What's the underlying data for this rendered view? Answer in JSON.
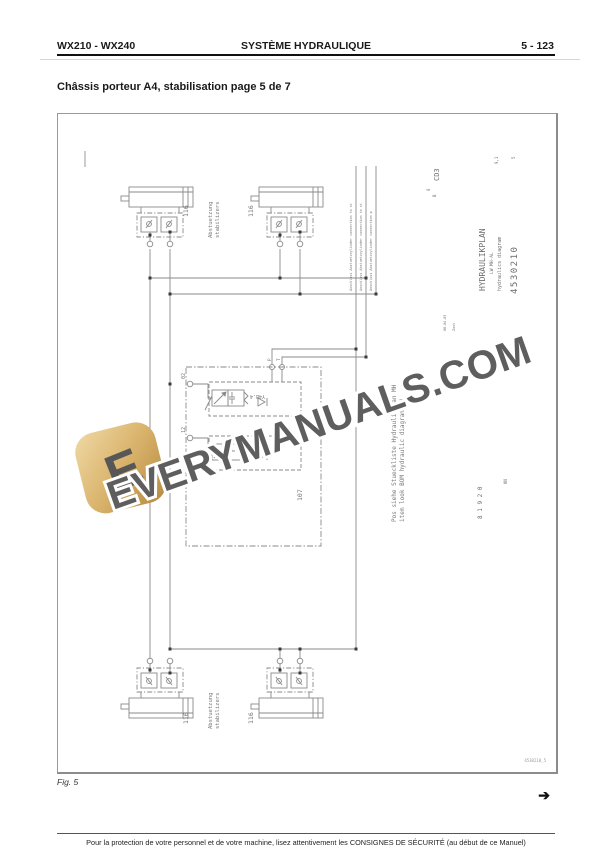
{
  "page": {
    "header": {
      "left": "WX210 - WX240",
      "center": "SYSTÈME HYDRAULIQUE",
      "right": "5 - 123"
    },
    "title": "Châssis porteur A4, stabilisation page 5 de 7",
    "fig_label": "Fig. 5",
    "nav_arrow": "➔",
    "footer": "Pour la protection de votre personnel et de votre machine, lisez attentivement les CONSIGNES DE SÉCURITÉ (au début de ce Manuel)"
  },
  "diagram": {
    "cylinder_labels": [
      "116",
      "116",
      "116",
      "116"
    ],
    "stabilizer_top": {
      "line1": "Abstuetzung",
      "line2": "stabilizers"
    },
    "stabilizer_bottom": {
      "line1": "Abstuetzung",
      "line2": "stabilizers"
    },
    "valve_block": {
      "valve_top_label": "Y4B.4",
      "valve_bottom_label": "Y4B.3",
      "port_left_top": "02",
      "port_left_bottom": "12",
      "port_p": "p",
      "port_t": "T",
      "block_ref": "107"
    },
    "connector_notes": [
      "Anschluss Abstuetzzylinder connection to st",
      "Anschluss Abstuetzzylinder connection to st",
      "Anschluss Abstuetzzylinder connection p"
    ],
    "bom_note_line1": "Pos siehe Stueckliste Hydraulikplan MH",
    "bom_note_line2": "item look BOM hydraulic diagram MH",
    "title_block": {
      "title": "HYDRAULIKPLAN",
      "subtitle": "LW MH-AL",
      "subtitle2": "hydraulics diagram",
      "number": "4530210",
      "code": "CD3",
      "mark_0": "0",
      "mark_b": "B",
      "rev_small": "9,1",
      "sheet_small": "5",
      "date_small": "08.04.03",
      "zust_small": "Zust",
      "serial": "8 1 9 2 0",
      "kn": "KN"
    },
    "corner_ref": "4530210_5"
  },
  "watermark": {
    "text": "EVERYMANUALS.COM",
    "logo_letter": "E"
  }
}
